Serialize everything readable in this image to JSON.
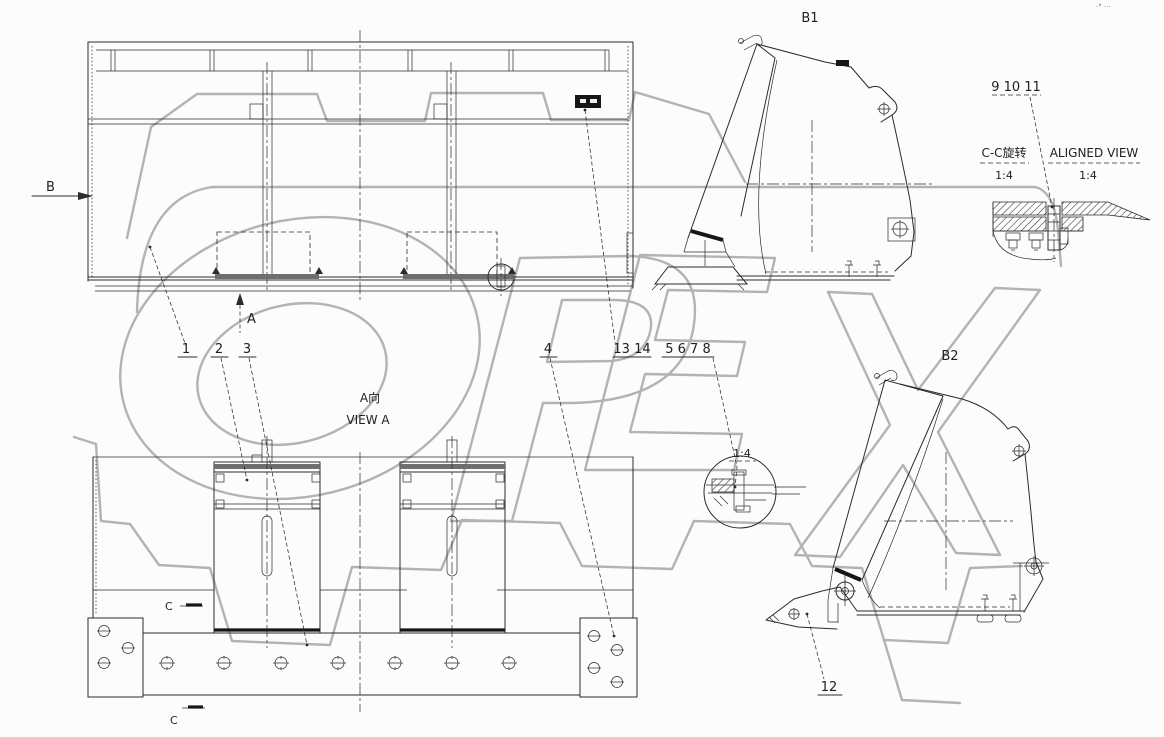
{
  "watermark": {
    "text": "OPEX"
  },
  "colors": {
    "background": "#fcfcfc",
    "line": "#2b2b2b",
    "watermark": "#b3b3b3",
    "label_plate": "#161616"
  },
  "views": {
    "rear": {
      "direction_marker": "B",
      "view_arrow": "A"
    },
    "view_a": {
      "title_cn": "A向",
      "title_en": "VIEW A",
      "section_marker": "C"
    },
    "b1": {
      "title": "B1"
    },
    "b2": {
      "title": "B2"
    },
    "section_cc": {
      "title_cn": "C-C旋转",
      "scale": "1:4"
    },
    "aligned": {
      "title": "ALIGNED VIEW",
      "scale": "1:4"
    },
    "detail": {
      "scale": "1:4"
    }
  },
  "callouts": {
    "c1": "1",
    "c2": "2",
    "c3": "3",
    "c4": "4",
    "c5678": "5 6 7 8",
    "c91011": "9 10 11",
    "c12": "12",
    "c1314": "13 14"
  },
  "corner_note": "·° ···"
}
